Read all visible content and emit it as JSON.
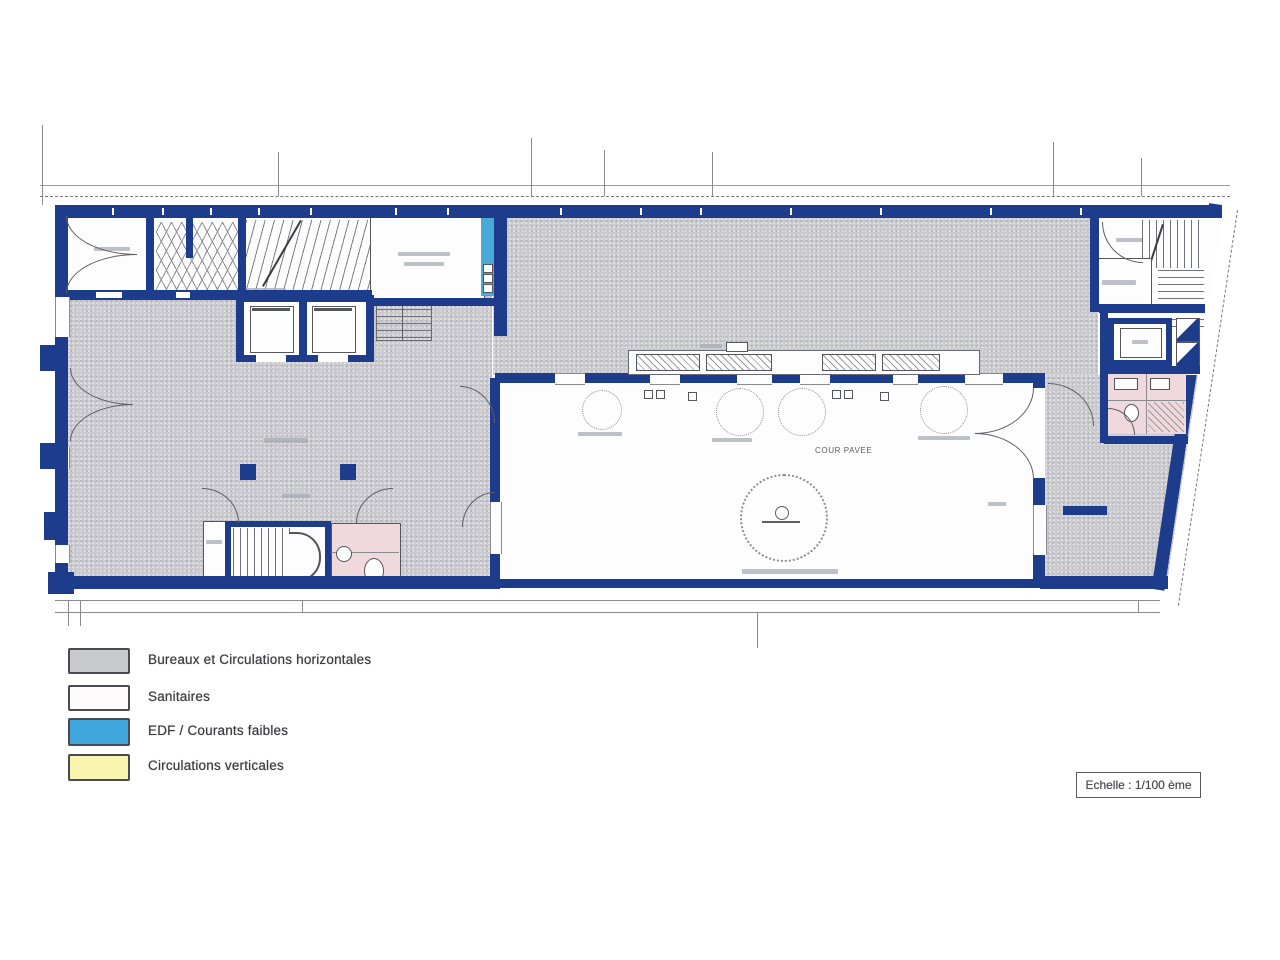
{
  "legend": {
    "items": [
      {
        "label": "Bureaux et Circulations horizontales",
        "color": "#c9cacd"
      },
      {
        "label": "Sanitaires",
        "color": "#fdfbfb"
      },
      {
        "label": "EDF / Courants faibles",
        "color": "#3fa7dd"
      },
      {
        "label": "Circulations verticales",
        "color": "#f7f5b0"
      }
    ]
  },
  "scale_box": {
    "label": "Echelle : 1/100 ème"
  },
  "plan": {
    "labels": {
      "courtyard": "COUR PAVEE"
    },
    "colors": {
      "wall": "#1e3c8c",
      "office_gray": "#c9c9ce",
      "sanitary_pink": "#efd9dc",
      "edf_blue": "#49a9d9",
      "line": "#5a5a5a"
    }
  }
}
